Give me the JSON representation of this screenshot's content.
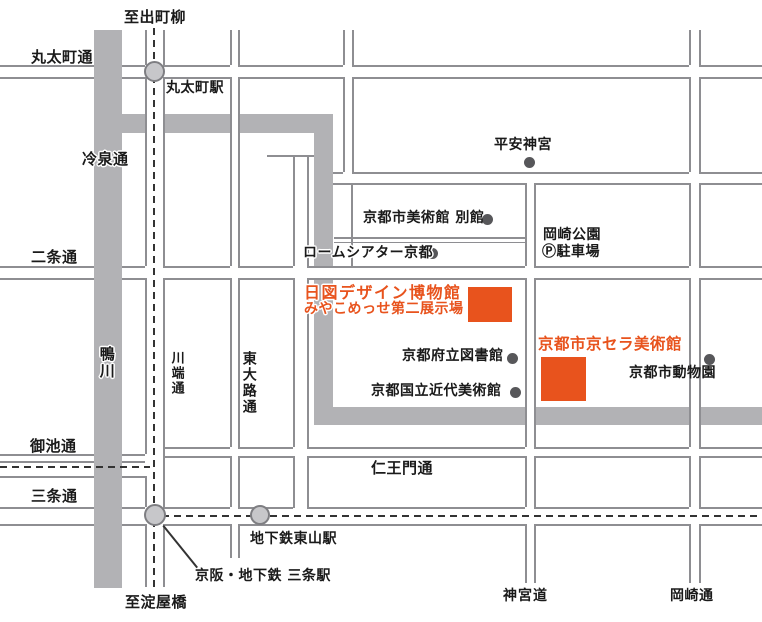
{
  "map": {
    "labels": {
      "to_demachiyanagi": "至出町柳",
      "marutamachi_dori": "丸太町通",
      "marutamachi_station": "丸太町駅",
      "reisen_dori": "冷泉通",
      "kamogawa": "鴨川",
      "nijo_dori": "二条通",
      "kawabata_dori": "川端通",
      "higashioji_dori": "東大路通",
      "oike_dori": "御池通",
      "sanjo_dori": "三条通",
      "heian_jingu": "平安神宮",
      "kyoto_city_art_museum_annex": "京都市美術館 別館",
      "rohm_theatre": "ロームシアター京都",
      "okazaki_park": "岡崎公園",
      "okazaki_parking": "Ⓟ駐車場",
      "hizu_design_museum": "日図デザイン博物館",
      "miyakomesse_hall": "みやこめっせ第二展示場",
      "kyocera_museum": "京都市京セラ美術館",
      "prefectural_library": "京都府立図書館",
      "momak": "京都国立近代美術館",
      "kyoto_zoo": "京都市動物園",
      "niomon_dori": "仁王門通",
      "higashiyama_station": "地下鉄東山駅",
      "sanjo_station": "京阪・地下鉄 三条駅",
      "to_yodoyabashi": "至淀屋橋",
      "jingu_michi": "神宮道",
      "okazaki_dori": "岡崎通"
    },
    "colors": {
      "highlight_orange": "#E8531D",
      "road_band_gray": "#B2B2B5",
      "road_line_gray": "#8E8E92",
      "dash_dark": "#333333",
      "station_fill": "#C7C7CA",
      "station_border": "#7E7E82",
      "poi_dot": "#57575A",
      "text": "#1A1A1A",
      "background": "#FFFFFF"
    }
  }
}
